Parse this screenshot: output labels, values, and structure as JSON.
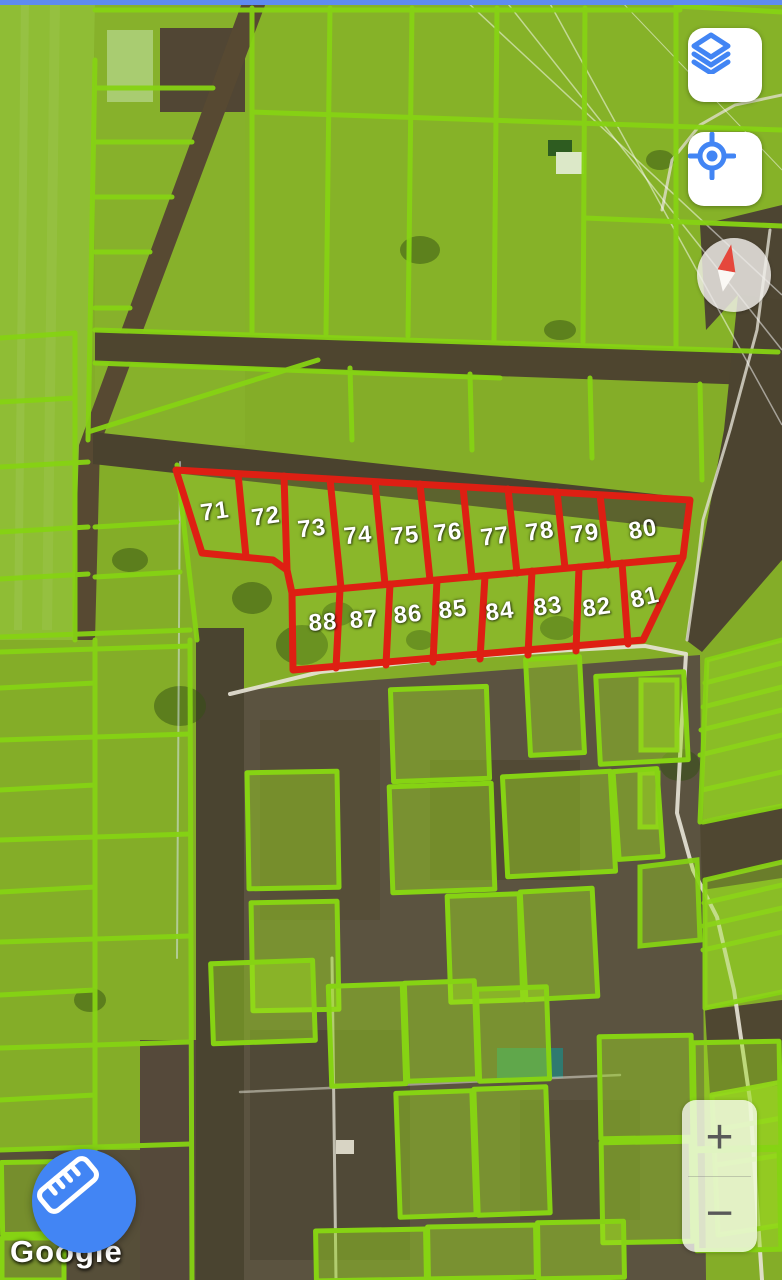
{
  "map": {
    "watermark_text": "Google",
    "top_boundary_color": "#5E8BF0",
    "parcel_outline_color": "#86D313",
    "subdivision_outline_color": "#DE1F13"
  },
  "subdivision": {
    "plot_numbers": [
      "71",
      "72",
      "73",
      "74",
      "75",
      "76",
      "77",
      "78",
      "79",
      "80",
      "81",
      "82",
      "83",
      "84",
      "85",
      "86",
      "87",
      "88"
    ]
  },
  "controls": {
    "layers_button": {
      "icon": "layers-icon",
      "color": "#4285F4"
    },
    "locate_button": {
      "icon": "my-location-icon",
      "color": "#4285F4"
    },
    "compass": {
      "icon": "compass-needle-icon",
      "needle_color": "#E5473C"
    },
    "zoom": {
      "in_label": "+",
      "out_label": "−"
    },
    "measure_button": {
      "icon": "ruler-icon",
      "color": "#4285F4"
    }
  }
}
